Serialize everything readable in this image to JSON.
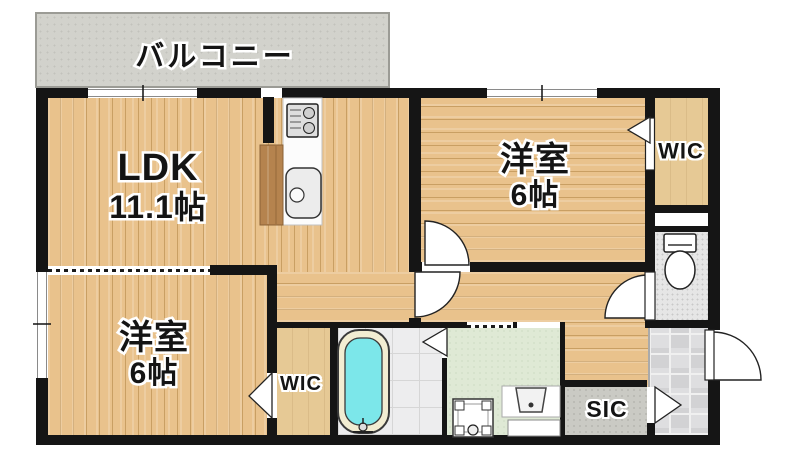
{
  "rooms": [
    {
      "id": "balcony",
      "label": "バルコニー"
    },
    {
      "id": "ldk",
      "label": "LDK",
      "area": "11.1帖"
    },
    {
      "id": "bedroom-upper",
      "label": "洋室",
      "area": "6帖"
    },
    {
      "id": "wic-upper",
      "label": "WIC"
    },
    {
      "id": "bedroom-lower",
      "label": "洋室",
      "area": "6帖"
    },
    {
      "id": "wic-lower",
      "label": "WIC"
    },
    {
      "id": "sic",
      "label": "SIC"
    }
  ],
  "fixtures": [
    {
      "name": "gas-stove"
    },
    {
      "name": "kitchen-sink"
    },
    {
      "name": "kitchen-counter"
    },
    {
      "name": "bathtub"
    },
    {
      "name": "toilet"
    },
    {
      "name": "washing-machine-pan"
    },
    {
      "name": "washbasin"
    },
    {
      "name": "entrance-door"
    }
  ],
  "colors": {
    "wall": "#151515",
    "wood_floor": "#e9c28c",
    "wood_plank_line": "#c99f63",
    "balcony": "#d2d2cc",
    "washroom_floor": "#dfe9d5",
    "bathtub_water": "#7ce7ea",
    "bathtub_rim": "#f2edd2",
    "genkan_tile": "#d8d8da",
    "sic_floor": "#cacac4",
    "wic_floor": "#e6c995",
    "toilet_floor": "#e6e6e6",
    "kitchen_cabinet": "#b5834e"
  }
}
